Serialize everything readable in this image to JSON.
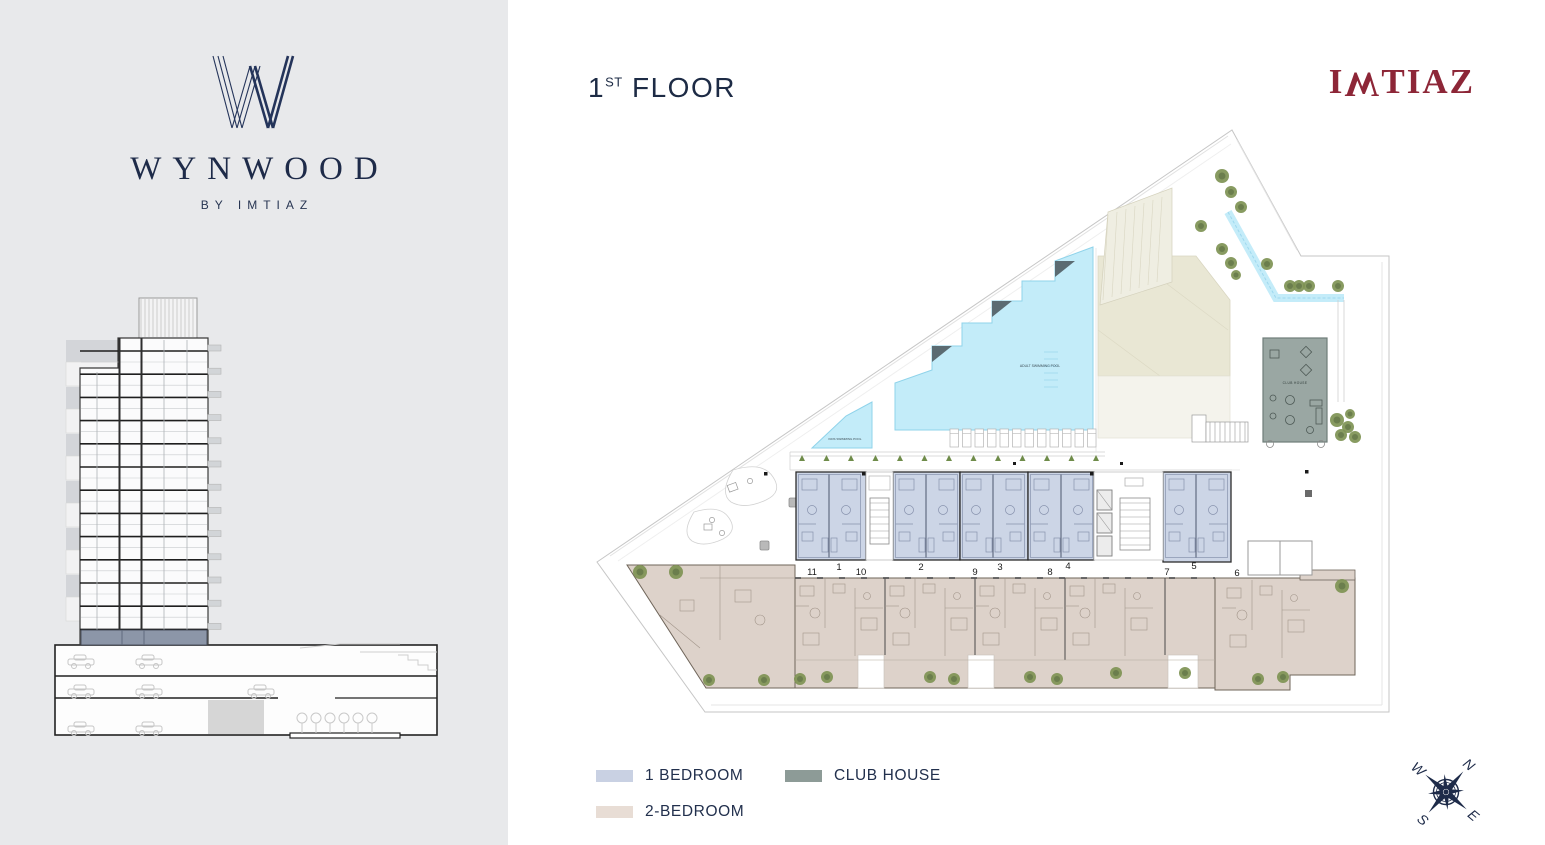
{
  "brand": {
    "wordmark": "WYNWOOD",
    "byline": "BY IMTIAZ",
    "developer_name": "IMTIAZ",
    "developer_logo": {
      "i": "I",
      "m_flipped": "W",
      "rest": "TIAZ"
    }
  },
  "header": {
    "floor_number": "1",
    "floor_ordinal": "ST",
    "floor_word": "FLOOR"
  },
  "legend": {
    "items": [
      {
        "label": "1 BEDROOM",
        "color": "#c9d1e3"
      },
      {
        "label": "2-BEDROOM",
        "color": "#e8ddd5"
      },
      {
        "label": "CLUB HOUSE",
        "color": "#8d9b97"
      }
    ]
  },
  "floor_plan": {
    "unit_numbers": [
      "11",
      "1",
      "10",
      "2",
      "9",
      "3",
      "8",
      "4",
      "7",
      "5",
      "6"
    ],
    "labels": {
      "adult_pool": "ADULT SWIMMING POOL",
      "kids_pool": "KIDS SWIMMING POOL",
      "club_house": "CLUB HOUSE"
    },
    "colors": {
      "one_bedroom_fill": "#ccd5e6",
      "two_bedroom_fill": "#ddd2ca",
      "club_house_fill": "#9aa7a3",
      "pool_fill": "#c3ecf9",
      "pool_edge": "#8fd3ea",
      "lawn_fill": "#e9e7d4",
      "tree": "#7e9254",
      "navy": "#1e2b49",
      "maroon": "#8d2637"
    }
  },
  "compass": {
    "n": "N",
    "e": "E",
    "s": "S",
    "w": "W"
  }
}
